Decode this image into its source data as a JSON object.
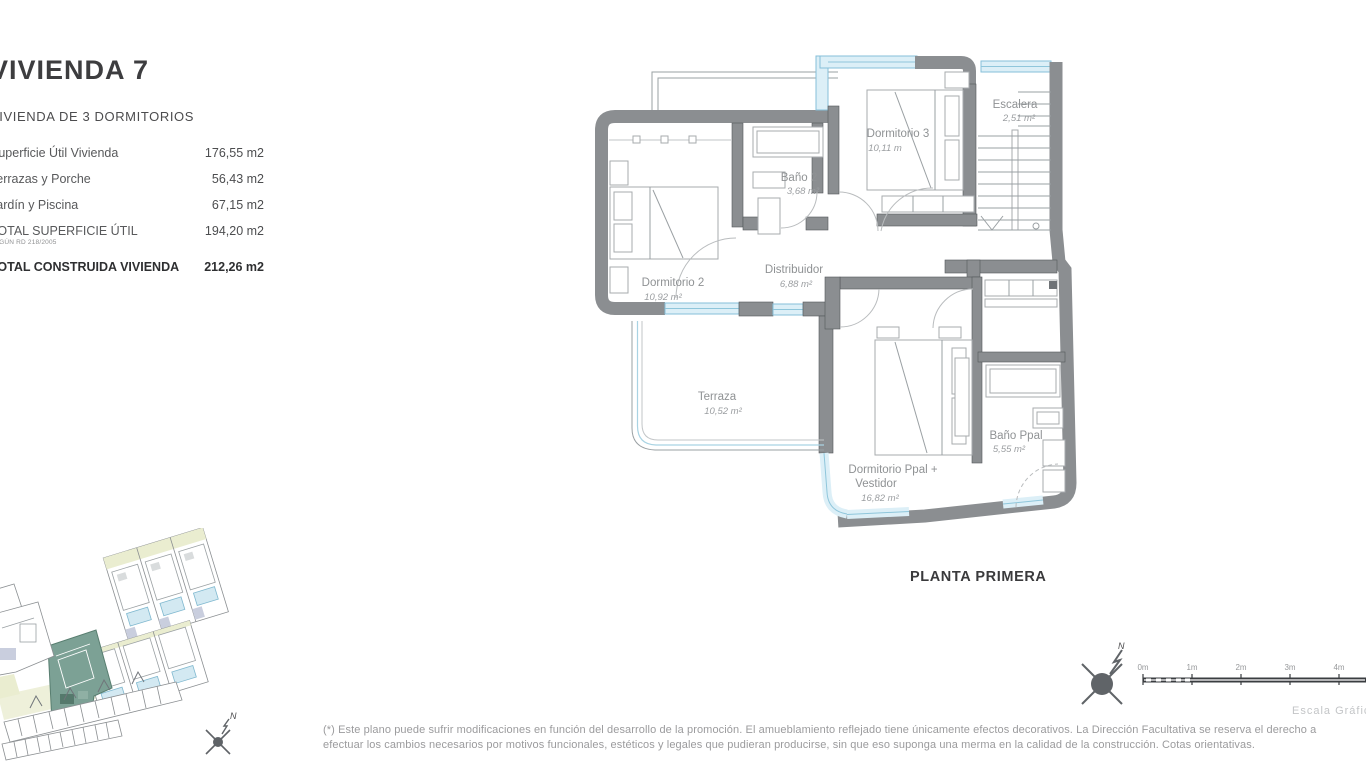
{
  "info_panel": {
    "title": "VIVIENDA 7",
    "subtitle": "VIVIENDA DE 3 DORMITORIOS",
    "rows": [
      {
        "label": "Superficie Útil Vivienda",
        "value": "176,55 m2"
      },
      {
        "label": "Terrazas y Porche",
        "value": "56,43 m2"
      },
      {
        "label": "Jardín y Piscina",
        "value": "67,15 m2"
      },
      {
        "label": "TOTAL SUPERFICIE ÚTIL",
        "note": "SEGÚN RD 218/2005",
        "value": "194,20 m2"
      },
      {
        "label": "TOTAL CONSTRUIDA VIVIENDA",
        "value": "212,26 m2"
      }
    ]
  },
  "floor_plan": {
    "caption": "PLANTA PRIMERA",
    "rooms": {
      "dormitorio2": {
        "name": "Dormitorio 2",
        "area": "10,92 m²"
      },
      "bano2": {
        "name": "Baño 2",
        "area": "3,68 m²"
      },
      "dormitorio3": {
        "name": "Dormitorio 3",
        "area": "10,11 m"
      },
      "escalera": {
        "name": "Escalera",
        "area": "2,51 m²"
      },
      "distribuidor": {
        "name": "Distribuidor",
        "area": "6,88 m²"
      },
      "terraza": {
        "name": "Terraza",
        "area": "10,52 m²"
      },
      "dormitorio_ppal": {
        "name": "Dormitorio Ppal +",
        "name2": "Vestidor",
        "area": "16,82 m²"
      },
      "bano_ppal": {
        "name": "Baño Ppal",
        "area": "5,55 m²"
      }
    }
  },
  "scale_bar": {
    "ticks": [
      "0m",
      "1m",
      "2m",
      "3m",
      "4m"
    ],
    "caption": "Escala Gráfica"
  },
  "compass": {
    "north_label": "N"
  },
  "site_plan": {
    "north_label": "N"
  },
  "footer": {
    "line1": "(*) Este plano puede sufrir modificaciones en función del desarrollo de la promoción. El amueblamiento reflejado tiene únicamente efectos decorativos. La Dirección Facultativa se reserva el derecho a",
    "line2": "efectuar los cambios necesarios por motivos funcionales, estéticos y legales que pudieran producirse, sin que eso suponga una merma en la calidad de la construcción. Cotas orientativas."
  },
  "colors": {
    "wall": "#8b8e91",
    "glazing": "#dceff7",
    "glazing_edge": "#86bfd8",
    "highlight_unit": "#7ca195",
    "parcel_yellow": "#eaedd0",
    "accent_lavender": "#c9cede",
    "text_dark": "#3a3a3c",
    "text_gray": "#8f9294"
  }
}
